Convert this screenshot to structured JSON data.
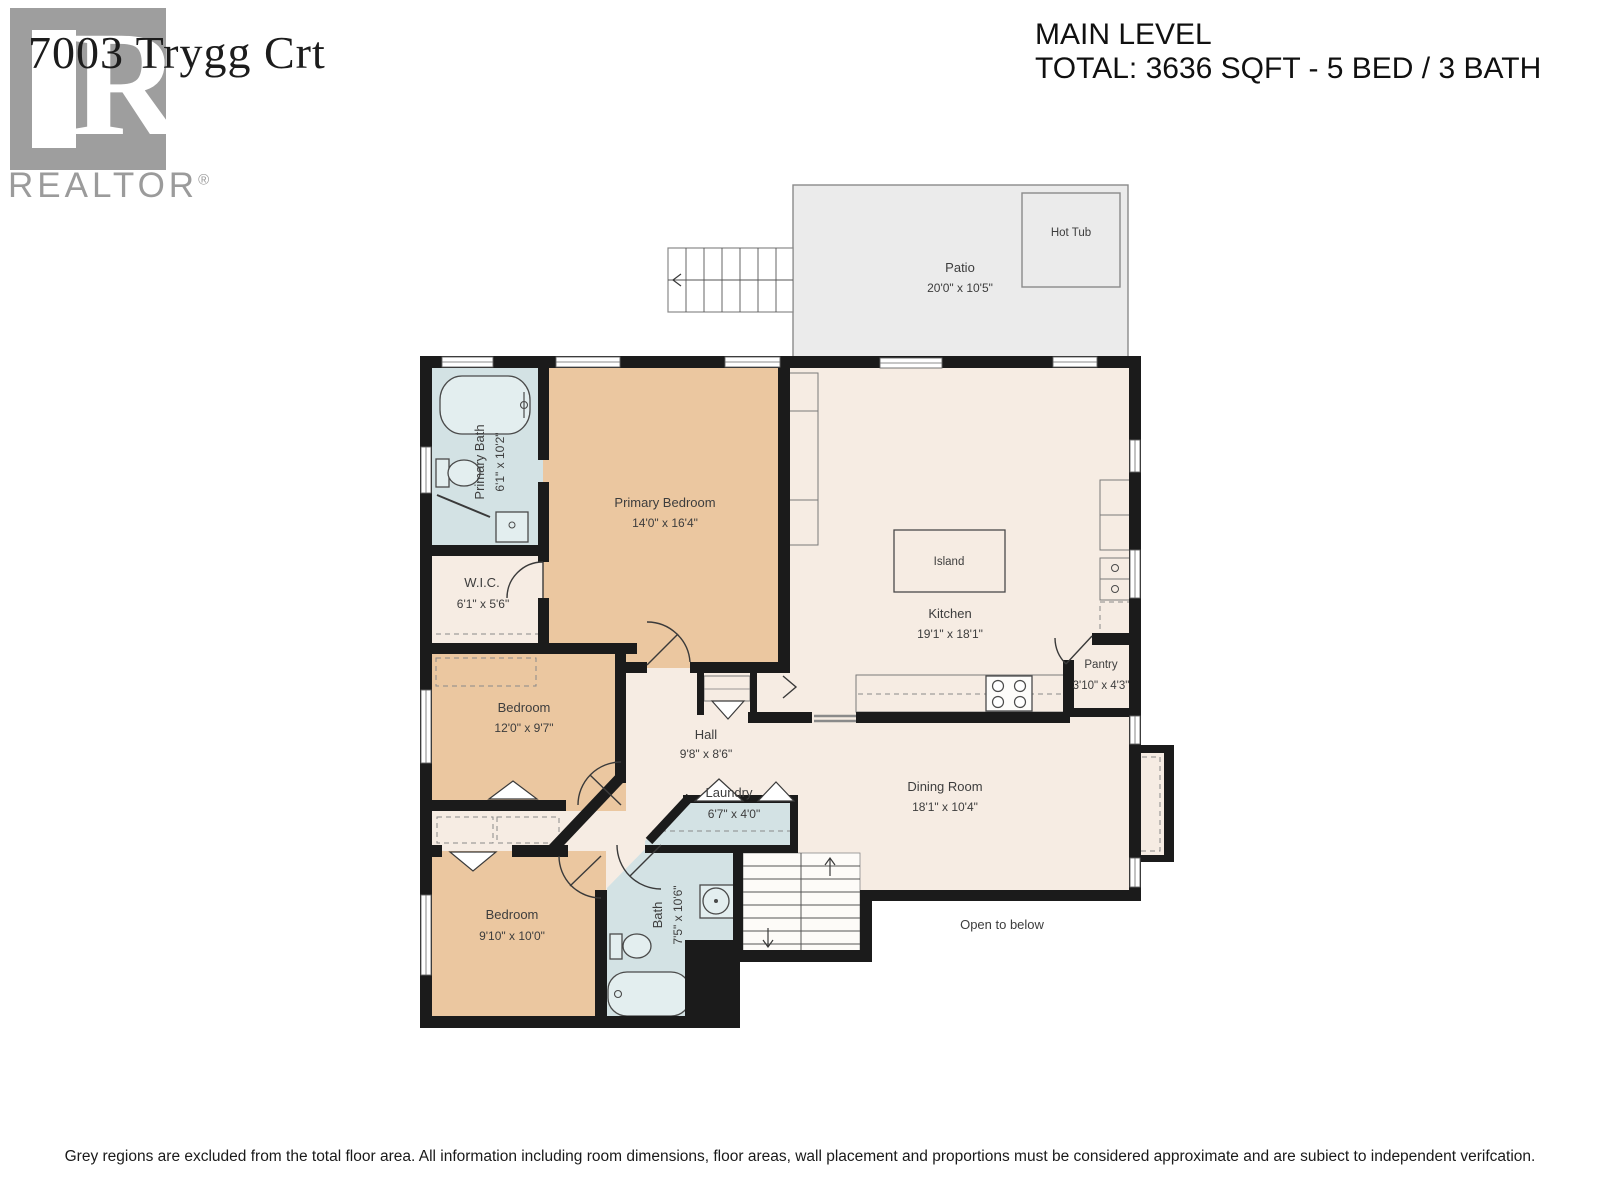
{
  "logo": {
    "address": "7003 Trygg Crt",
    "wordmark": "REALTOR",
    "registered_mark": "®",
    "monogram": "R"
  },
  "header": {
    "title": "MAIN LEVEL",
    "subtitle": "TOTAL: 3636 SQFT - 5 BED / 3 BATH"
  },
  "rooms": {
    "patio": {
      "name": "Patio",
      "dims": "20'0\" x 10'5\""
    },
    "hot_tub": {
      "name": "Hot Tub"
    },
    "primary_bath": {
      "name": "Primary Bath",
      "dims": "6'1\" x 10'2\""
    },
    "primary_bedroom": {
      "name": "Primary Bedroom",
      "dims": "14'0\" x 16'4\""
    },
    "wic": {
      "name": "W.I.C.",
      "dims": "6'1\" x 5'6\""
    },
    "bedroom2": {
      "name": "Bedroom",
      "dims": "12'0\" x 9'7\""
    },
    "hall": {
      "name": "Hall",
      "dims": "9'8\" x 8'6\""
    },
    "laundry": {
      "name": "Laundry",
      "dims": "6'7\" x 4'0\""
    },
    "kitchen": {
      "name": "Kitchen",
      "dims": "19'1\" x 18'1\""
    },
    "island": {
      "name": "Island"
    },
    "pantry": {
      "name": "Pantry",
      "dims": "3'10\" x 4'3\""
    },
    "dining": {
      "name": "Dining Room",
      "dims": "18'1\" x 10'4\""
    },
    "bedroom3": {
      "name": "Bedroom",
      "dims": "9'10\" x 10'0\""
    },
    "bath2": {
      "name": "Bath",
      "dims": "7'5\" x 10'6\""
    },
    "open_below": {
      "name": "Open to below"
    }
  },
  "disclaimer": "Grey regions are excluded from the total floor area. All information including room dimensions, floor areas, wall placement and proportions must be considered approximate and are subiect to independent verifcation.",
  "colors": {
    "wall": "#1b1b1b",
    "bedroom_fill": "#ebc7a0",
    "bath_fill": "#d3e2e4",
    "floor_fill": "#f6ece3",
    "patio_fill": "#ebebeb",
    "label_text": "#3d3d3d"
  }
}
